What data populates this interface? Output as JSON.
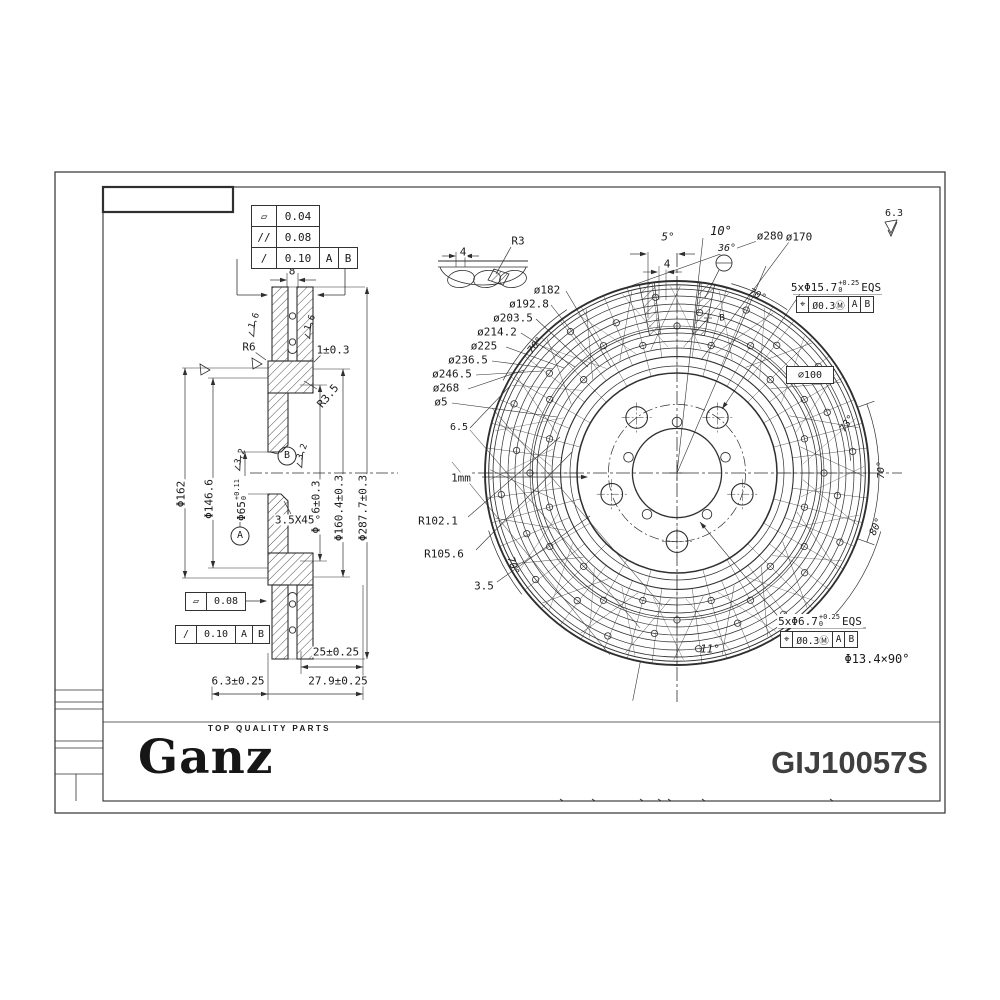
{
  "meta": {
    "brand": "Ganz",
    "tagline": "TOP QUALITY PARTS",
    "part_number": "GIJ10057S"
  },
  "colors": {
    "line": "#2f2f2f",
    "text": "#1a1a1a",
    "part_number": "#3f3f3f"
  },
  "tolerance_stack": {
    "rows": [
      {
        "symbol": "▱",
        "value": "0.04"
      },
      {
        "symbol": "//",
        "value": "0.08"
      },
      {
        "symbol": "/",
        "value": "0.10",
        "a": "A",
        "b": "B"
      }
    ]
  },
  "section": {
    "flat": {
      "symbol": "▱",
      "value": "0.08"
    },
    "runout": {
      "symbol": "/",
      "value": "0.10",
      "a": "A",
      "b": "B"
    }
  },
  "front": {
    "fcf_studs": [
      "⌖",
      "Ø0.3Ⓜ",
      "A",
      "B"
    ],
    "fcf_pins": [
      "⌖",
      "Ø0.3Ⓜ",
      "A",
      "B"
    ],
    "pcd": "⌀100"
  },
  "labels": {
    "sec_8": "8",
    "rough_16a": "1.6",
    "rough_16b": "1.6",
    "r6": "R6",
    "gap_1": "1±0.3",
    "r35": "R3.5",
    "rough_32a": "3.2",
    "rough_32b": "3.2",
    "d65": {
      "main": "Φ65",
      "sup": "+0.11",
      "sub": "0"
    },
    "d1466": "Φ146.6",
    "d162": "Φ162",
    "d136": "Φ136±0.3",
    "d1604": "Φ160.4±0.3",
    "d2877": "Φ287.7±0.3",
    "chamfer": "3.5X45°",
    "datum_a": "A",
    "datum_b": "B",
    "d25": "25±0.25",
    "d63": "6.3±0.25",
    "d279": "27.9±0.25",
    "det_4": "4",
    "det_r3": "R3",
    "a5": "5°",
    "a10": "10°",
    "a36": "36°",
    "f4": "4",
    "d280": "ø280",
    "d170": "ø170",
    "r63": "6.3",
    "eqs157": {
      "main": "5xΦ15.7",
      "sup": "+0.25",
      "sub": "0",
      "suffix": "EQS"
    },
    "o182": "ø182",
    "o1928": "ø192.8",
    "o2035": "ø203.5",
    "o2142": "ø214.2",
    "o225": "ø225",
    "o2365": "ø236.5",
    "o2465": "ø246.5",
    "o268": "ø268",
    "o5": "ø5",
    "s65": "6.5",
    "a70ul": "70°",
    "a70t": "70°",
    "a70ll": "70°",
    "a70r": "70°",
    "a73": "73°",
    "a80": "80°",
    "a11": "11°",
    "mm1": "1mm",
    "r1021": "R102.1",
    "r1056": "R105.6",
    "t35": "3.5",
    "eqs67": {
      "main": "5xΦ6.7",
      "sup": "+0.25",
      "sub": "0",
      "suffix": "EQS"
    },
    "d134": "Φ13.4×90°",
    "hub_b": "B"
  }
}
